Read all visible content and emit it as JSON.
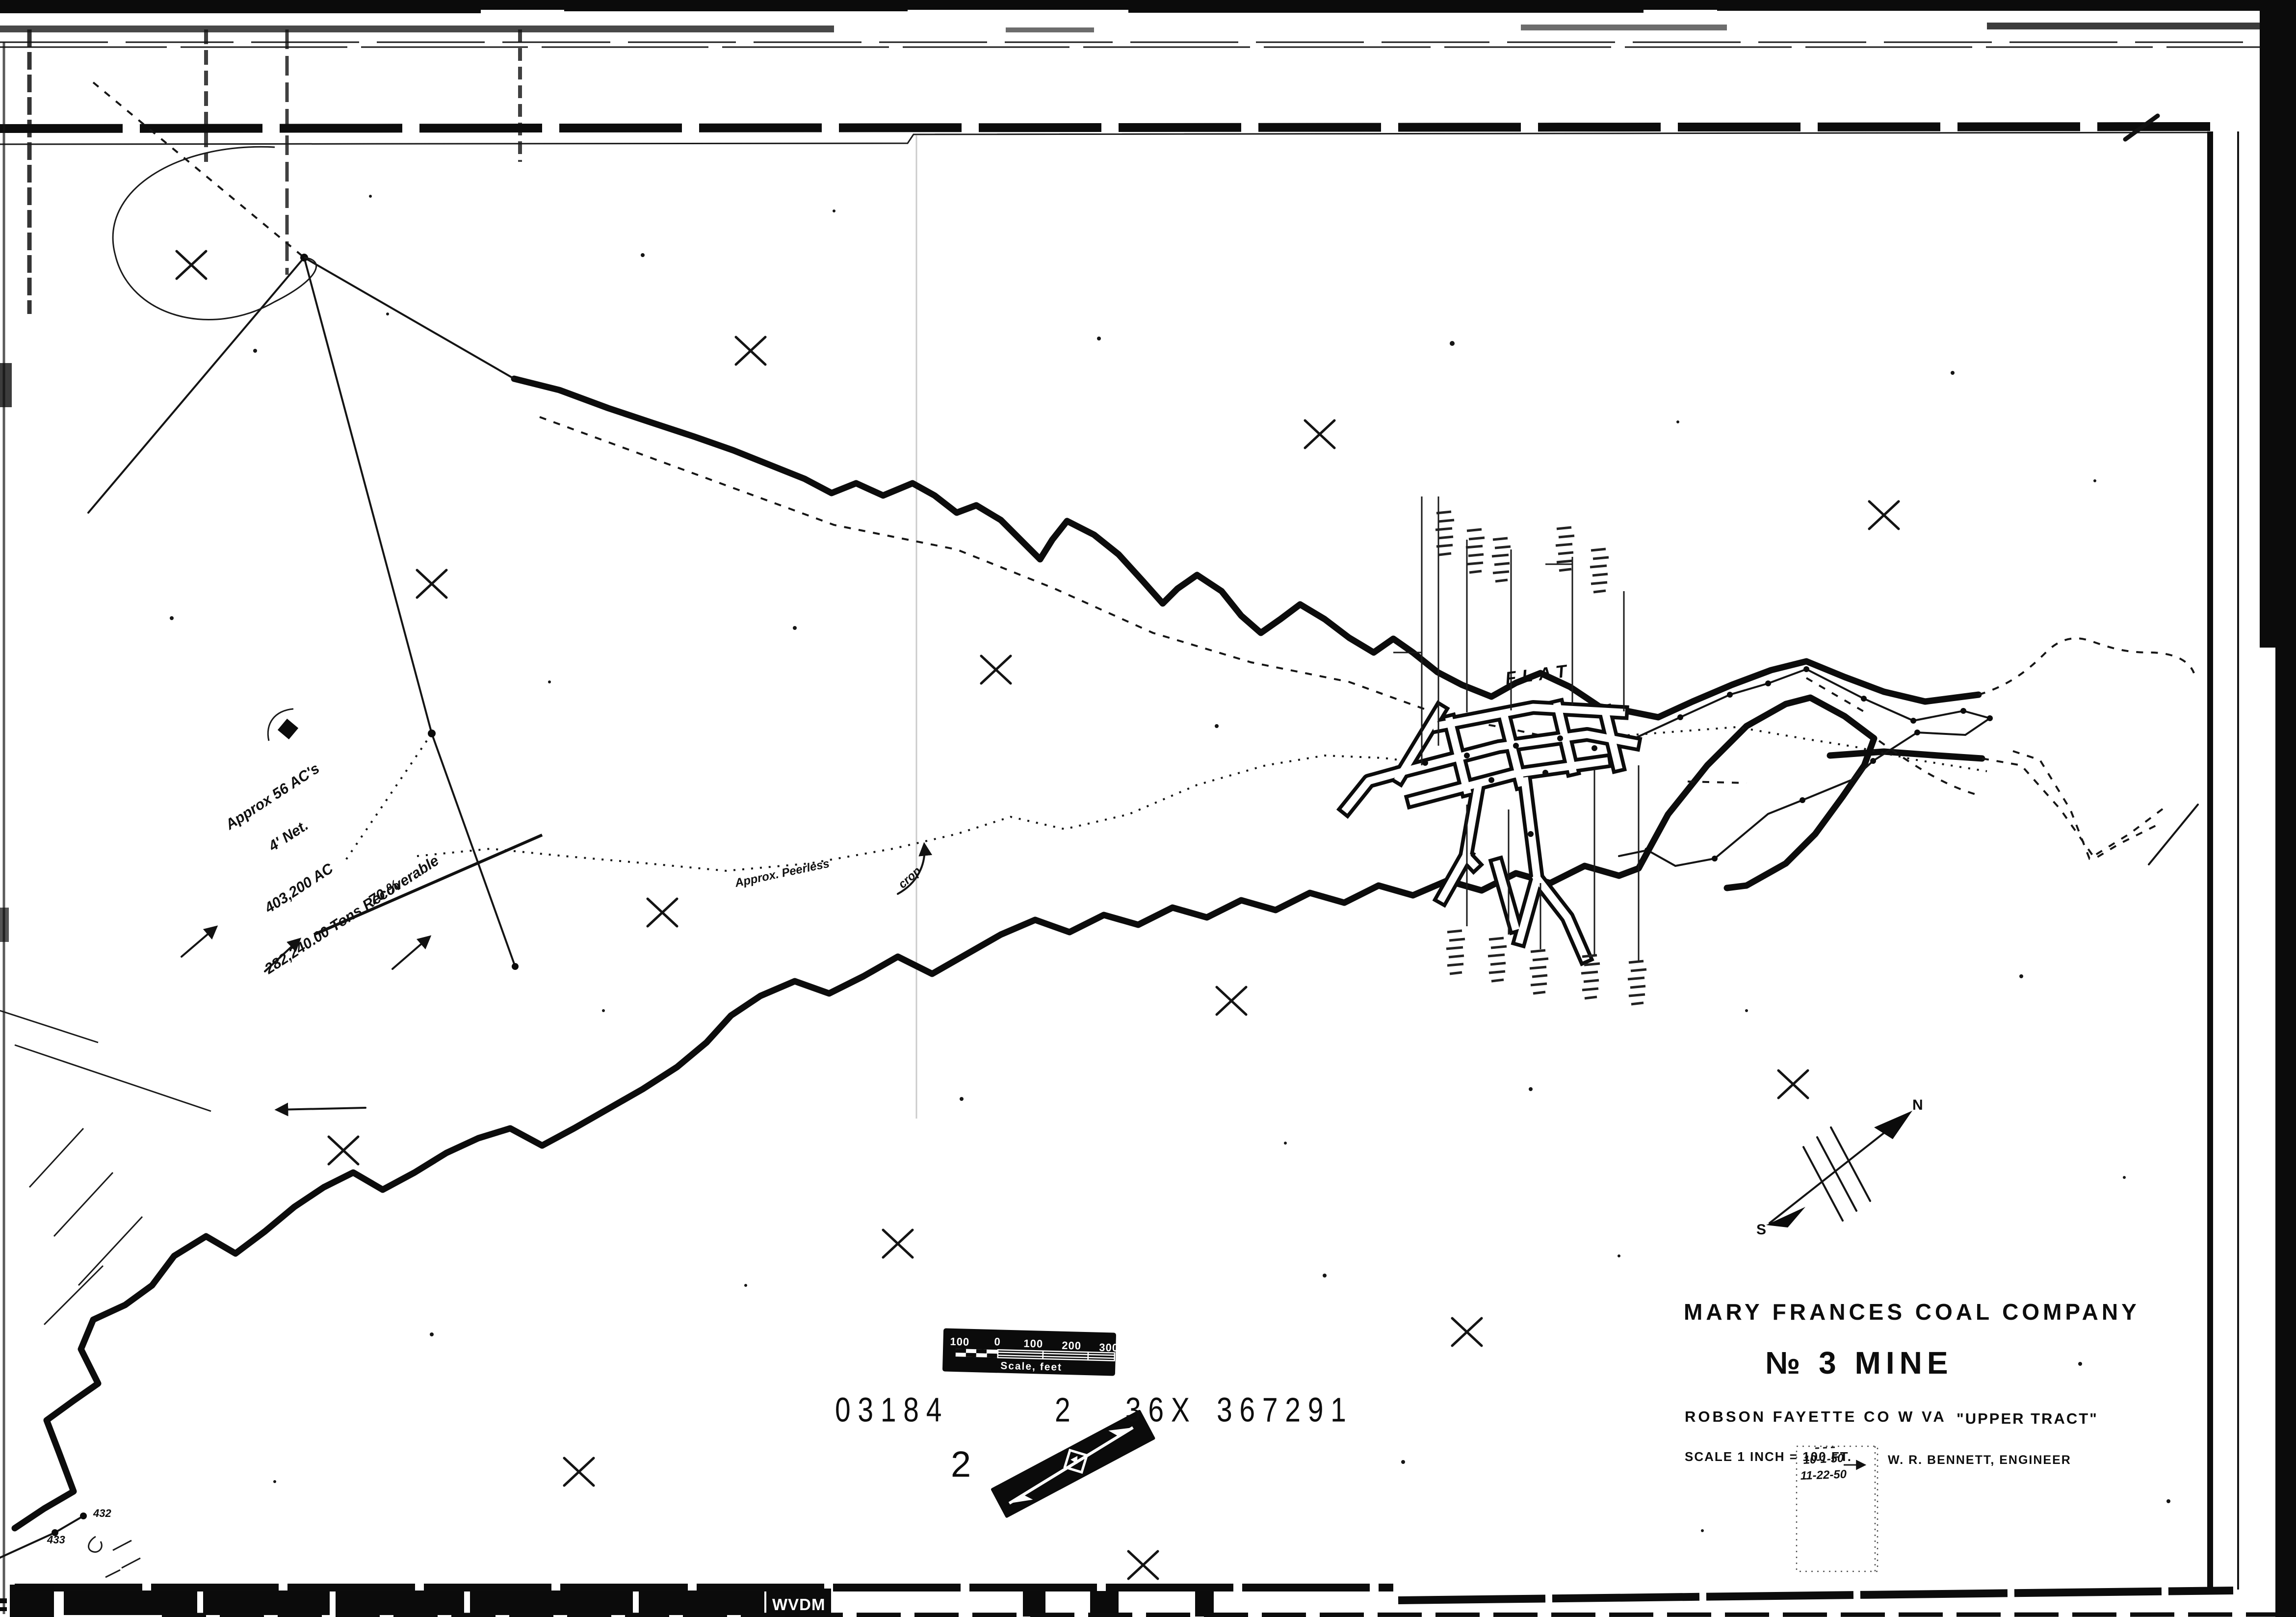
{
  "sheet": {
    "title_block": {
      "company": "MARY FRANCES COAL COMPANY",
      "mine": "№ 3   MINE",
      "location": "ROBSON  FAYETTE  CO   W  VA",
      "tract": "\"UPPER TRACT\"",
      "scale_note": "SCALE   1 INCH = 100 FT.",
      "engineer": "W. R. BENNETT, ENGINEER"
    },
    "scale_bar": {
      "labels": [
        "100",
        "0",
        "100",
        "200",
        "300"
      ],
      "caption": "Scale, feet"
    },
    "north_arrow": {
      "north": "N",
      "south": "S"
    },
    "sheet_number": "2",
    "stamp_dates": {
      "date1": "10-1-50",
      "date2": "11-22-50"
    },
    "map_labels": {
      "flat": "FLAT",
      "crop_note_1": "Approx. Peerless",
      "crop_note_2": "crop",
      "station_432": "432",
      "station_433": "433"
    },
    "reserve_note": {
      "l1": "Approx 56 AC's",
      "l2": "4' Net.",
      "l3": "403,200 AC",
      "l4": "70 %",
      "l5": "282,240.00 Tons Recoverable"
    },
    "film_strip": {
      "agency": "WVDM",
      "reel": "03184",
      "frame": "2",
      "size_code": "36X",
      "document_number": "367291"
    },
    "colors": {
      "paper": "#ffffff",
      "ink": "#0b0b0b"
    }
  }
}
